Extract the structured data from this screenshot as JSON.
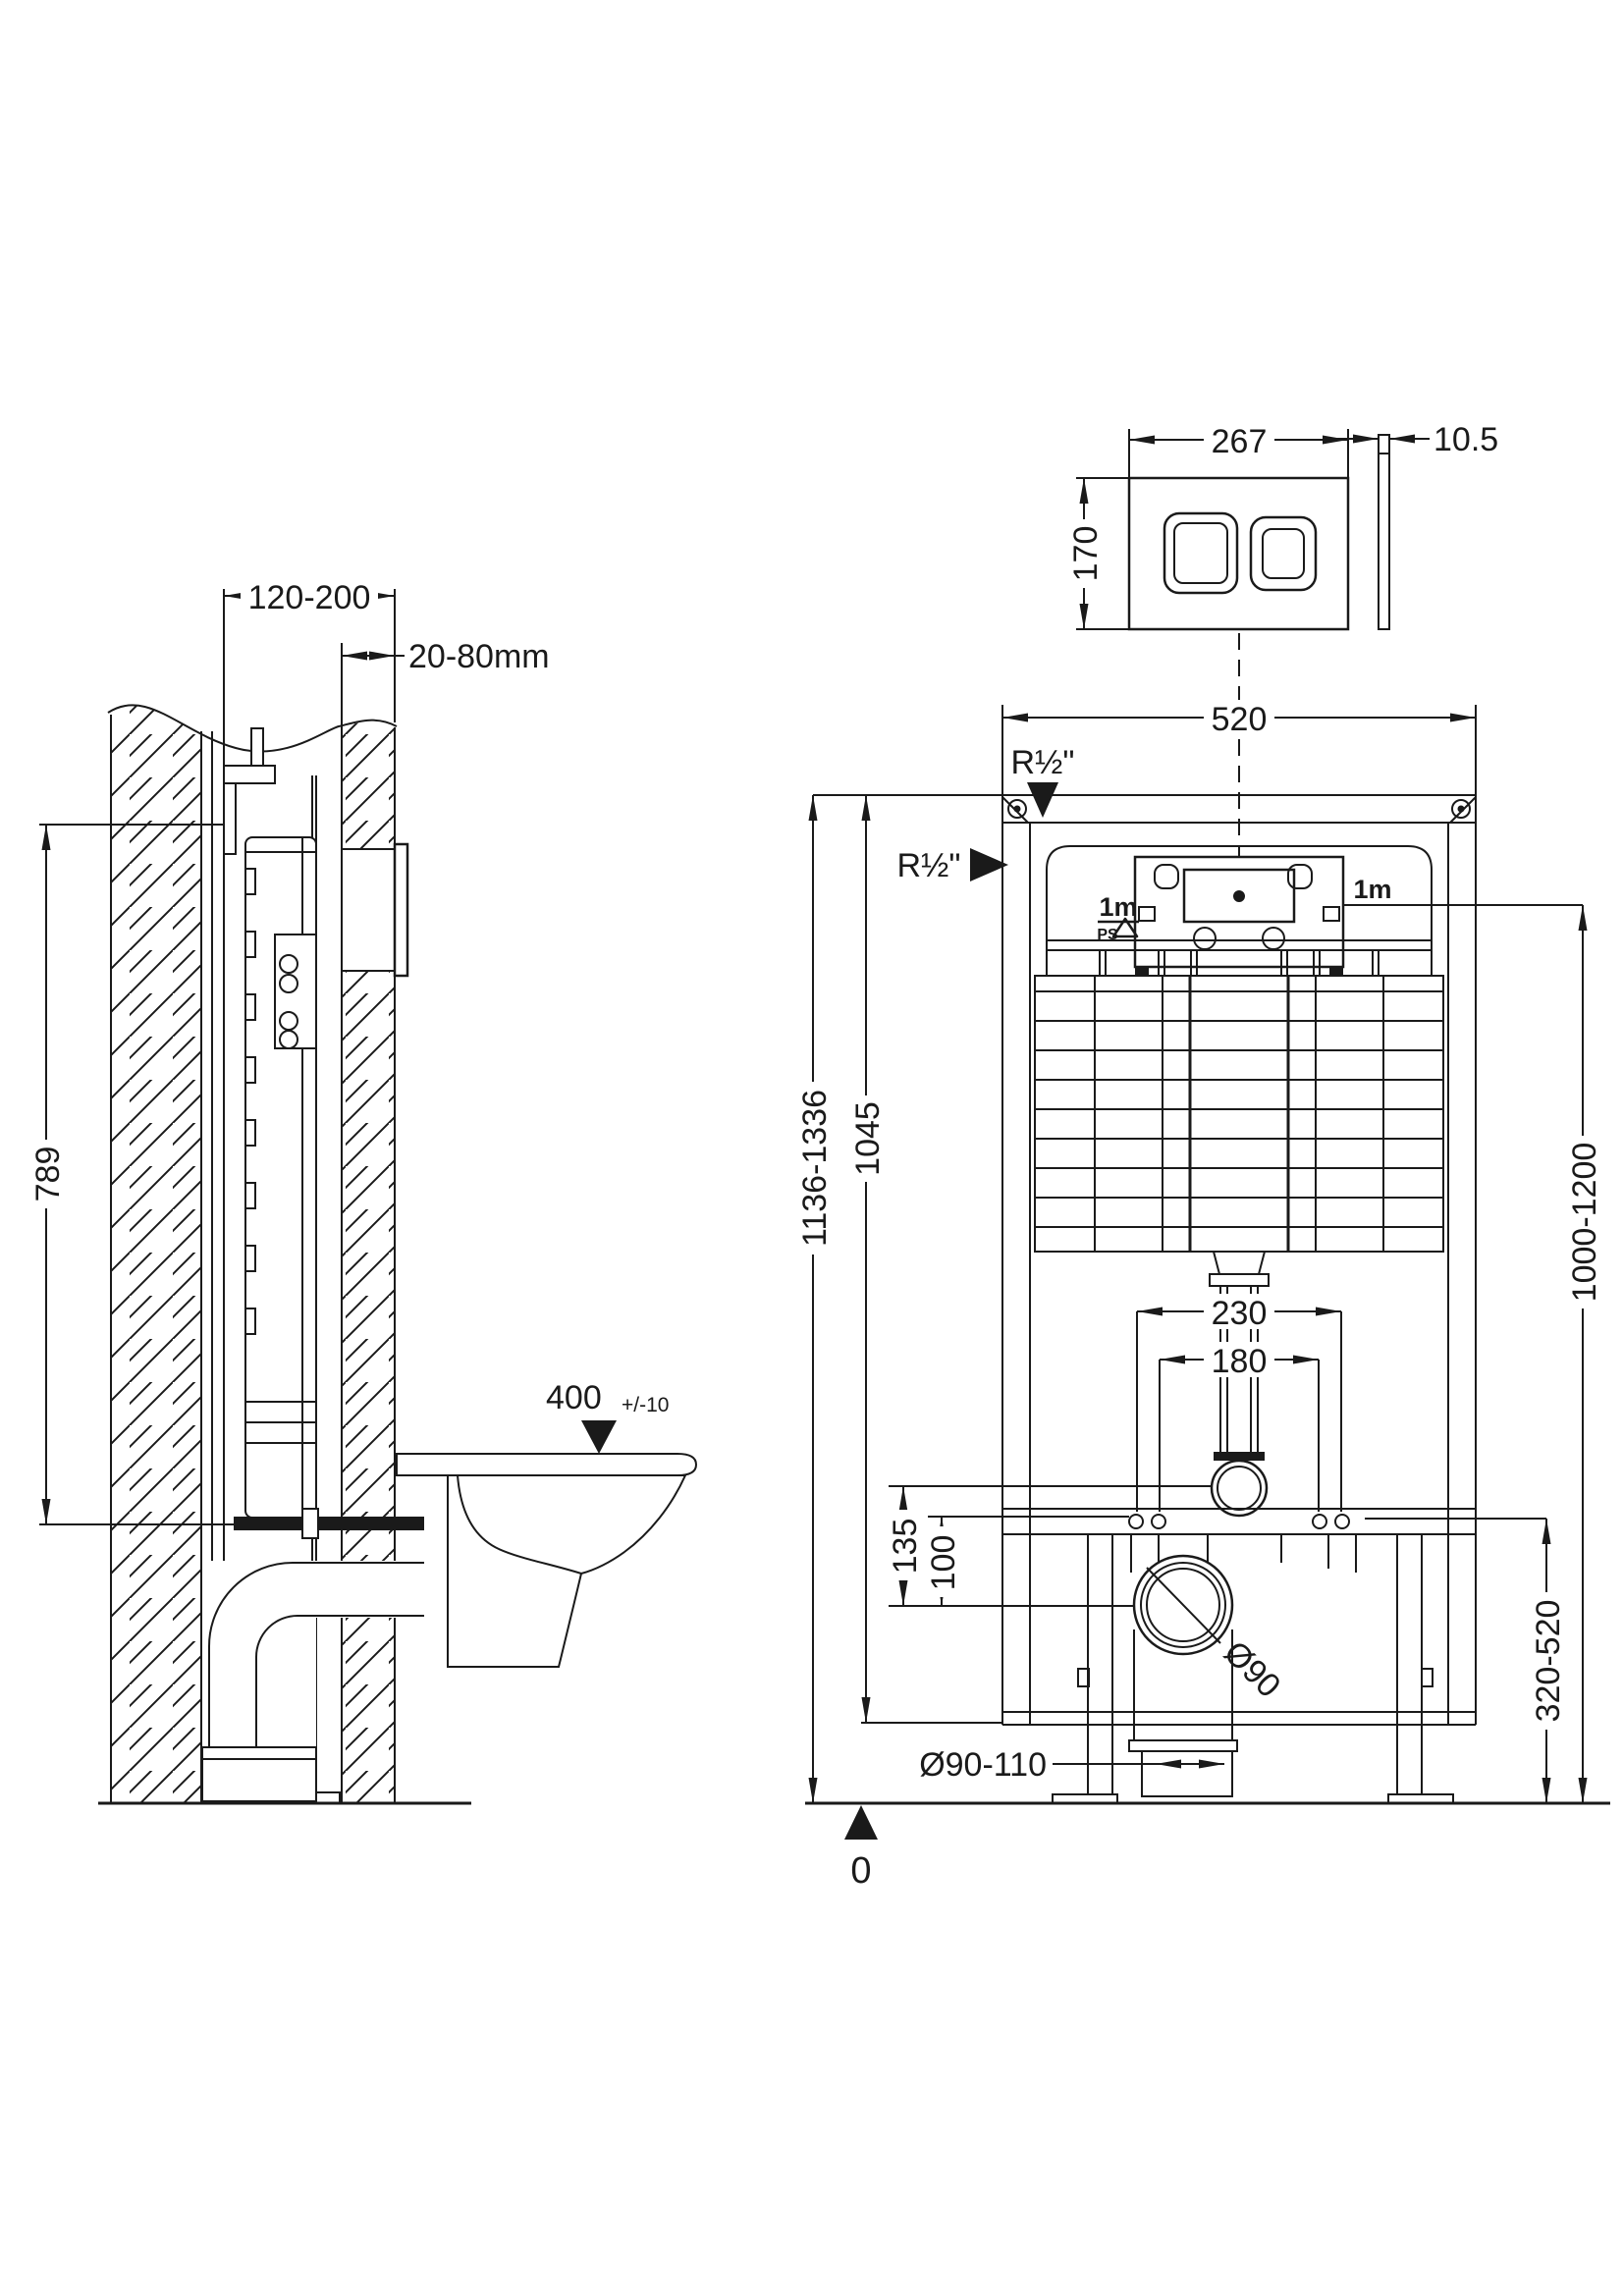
{
  "style": {
    "line_color": "#1a1a1a",
    "background": "#ffffff"
  },
  "side_view": {
    "frame_depth": "120-200",
    "finished_wall_thickness": "20-80mm",
    "cistern_top_height": "789",
    "seat_height": "400",
    "seat_height_tolerance": "+/-10"
  },
  "flush_plate": {
    "width": "267",
    "height": "170",
    "thickness": "10.5"
  },
  "front_view": {
    "frame_width": "520",
    "water_supply_top": "R½\"",
    "water_supply_side": "R½\"",
    "hose_left": "1m",
    "hose_right": "1m",
    "ps_mark": "PS",
    "fixing_bolts_outer": "230",
    "fixing_bolts_inner": "180",
    "overall_height_range": "1136-1336",
    "frame_height": "1045",
    "supply_height_range": "1000-1200",
    "flush_bend_offset": "135",
    "fixing_holes_offset": "100",
    "drain_height_range": "320-520",
    "drain_diameter": "Ø90",
    "outlet_diameter": "Ø90-110",
    "floor_datum": "0"
  }
}
